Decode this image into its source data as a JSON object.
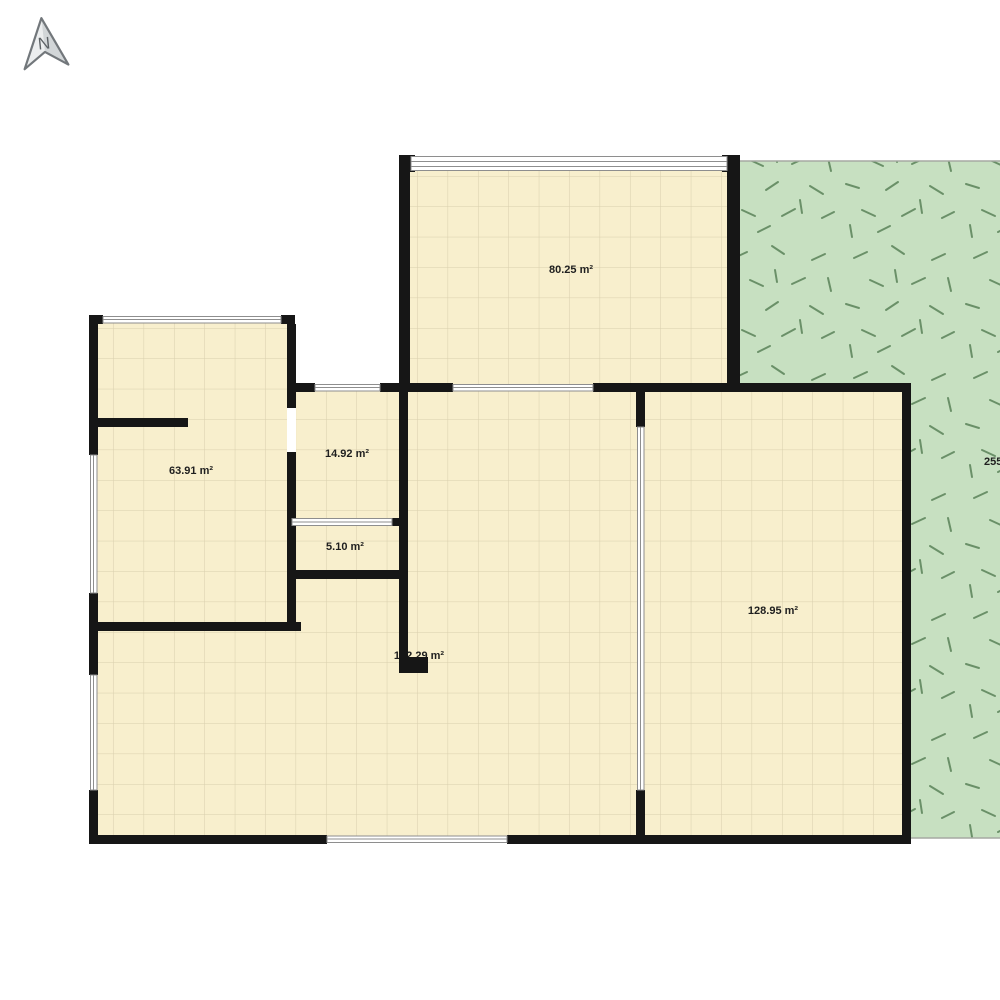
{
  "compass": {
    "label": "N"
  },
  "rooms": [
    {
      "name": "top-room",
      "area_label": "80.25 m²"
    },
    {
      "name": "left-room",
      "area_label": "63.91 m²"
    },
    {
      "name": "small-room",
      "area_label": "14.92 m²"
    },
    {
      "name": "tiny-room",
      "area_label": "5.10 m²"
    },
    {
      "name": "main-room",
      "area_label": "182.29 m²"
    },
    {
      "name": "right-room",
      "area_label": "128.95 m²"
    }
  ],
  "garden": {
    "area_label_visible": "255"
  },
  "colors": {
    "wall": "#161616",
    "floor": "#f8efcd",
    "floor_grid": "#d9cfad",
    "garden": "#c7e0c1",
    "grass_dash": "#6a9068",
    "window_fill": "#ffffff",
    "window_frame": "#8e8e8e",
    "garden_edge": "#a6a9a2"
  }
}
